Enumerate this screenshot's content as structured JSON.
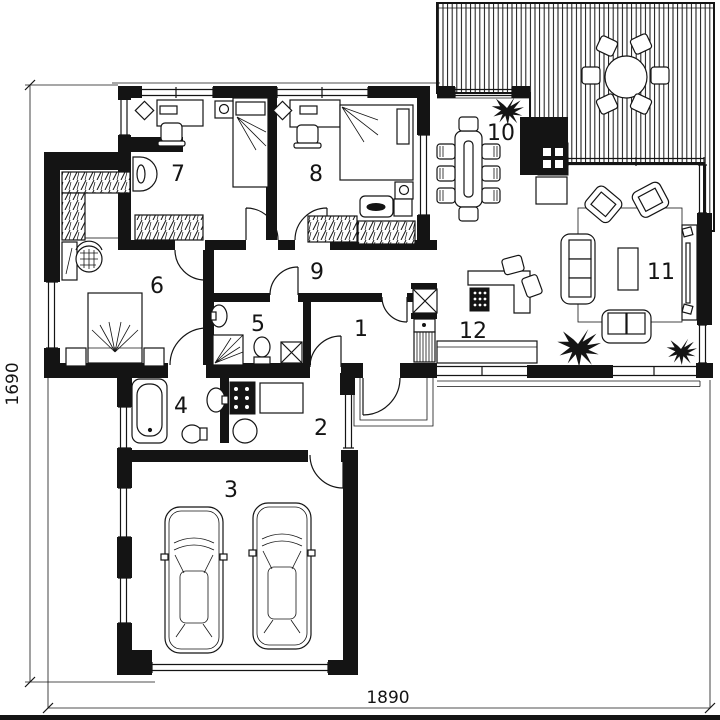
{
  "rooms": [
    {
      "number": "1"
    },
    {
      "number": "2"
    },
    {
      "number": "3"
    },
    {
      "number": "4"
    },
    {
      "number": "5"
    },
    {
      "number": "6"
    },
    {
      "number": "7"
    },
    {
      "number": "8"
    },
    {
      "number": "9"
    },
    {
      "number": "10"
    },
    {
      "number": "11"
    },
    {
      "number": "12"
    }
  ],
  "dimensions": {
    "vertical": "1690",
    "horizontal": "1890"
  },
  "colors": {
    "ink": "#141414",
    "background": "#ffffff"
  }
}
